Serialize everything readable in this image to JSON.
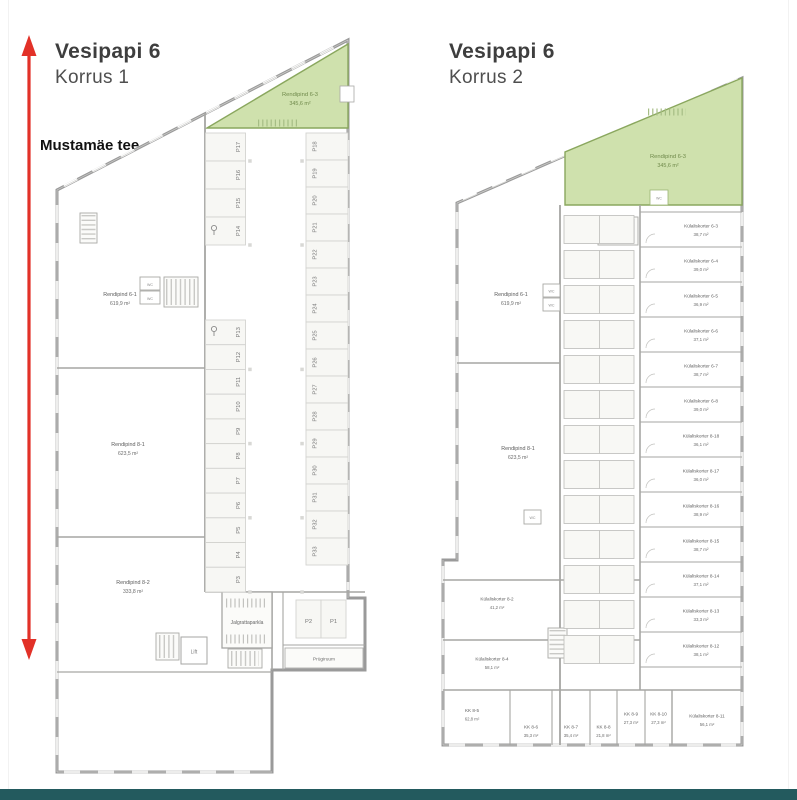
{
  "street_label": "Mustamäe tee",
  "labels": {
    "wc": "WC",
    "lift": "Lift",
    "bike_room": "Jalgrattaparkla",
    "waste_room": "Prügiruum"
  },
  "colors": {
    "highlight_fill": "#cfe1ad",
    "highlight_border": "#8aa75e",
    "arrow": "#e23128",
    "wall": "#9a9a9a",
    "footer": "#235a5e"
  },
  "left_plan": {
    "title": "Vesipapi 6",
    "subtitle": "Korrus 1",
    "highlight": {
      "name": "Rendipind 6-3",
      "size": "345,6 m²"
    },
    "areas": [
      {
        "name": "Rendipind 6-1",
        "size": "619,9 m²"
      },
      {
        "name": "Rendipind 8-1",
        "size": "623,5 m²"
      },
      {
        "name": "Rendipind 8-2",
        "size": "333,8 m²"
      }
    ],
    "parking_left": [
      "P17",
      "P16",
      "P15",
      "P14",
      "P13",
      "P12",
      "P11",
      "P10",
      "P9",
      "P8",
      "P7",
      "P6",
      "P5",
      "P4",
      "P3"
    ],
    "parking_right": [
      "P18",
      "P19",
      "P20",
      "P21",
      "P22",
      "P23",
      "P24",
      "P25",
      "P26",
      "P27",
      "P28",
      "P29",
      "P30",
      "P31",
      "P32",
      "P33"
    ],
    "parking_entry": [
      "P2",
      "P1"
    ]
  },
  "right_plan": {
    "title": "Vesipapi 6",
    "subtitle": "Korrus 2",
    "highlight": {
      "name": "Rendipind 6-3",
      "size": "345,6 m²"
    },
    "areas": [
      {
        "name": "Rendipind 6-1",
        "size": "619,9 m²"
      },
      {
        "name": "Rendipind 8-1",
        "size": "623,5 m²"
      }
    ],
    "units_right": [
      {
        "name": "Külaliskorter 6-3",
        "size": "38,7 m²"
      },
      {
        "name": "Külaliskorter 6-4",
        "size": "39,0 m²"
      },
      {
        "name": "Külaliskorter 6-5",
        "size": "36,9 m²"
      },
      {
        "name": "Külaliskorter 6-6",
        "size": "37,1 m²"
      },
      {
        "name": "Külaliskorter 6-7",
        "size": "38,7 m²"
      },
      {
        "name": "Külaliskorter 6-8",
        "size": "39,0 m²"
      },
      {
        "name": "Külaliskorter 8-18",
        "size": "36,1 m²"
      },
      {
        "name": "Külaliskorter 8-17",
        "size": "36,0 m²"
      },
      {
        "name": "Külaliskorter 8-16",
        "size": "38,9 m²"
      },
      {
        "name": "Külaliskorter 8-15",
        "size": "38,7 m²"
      },
      {
        "name": "Külaliskorter 8-14",
        "size": "37,1 m²"
      },
      {
        "name": "Külaliskorter 8-13",
        "size": "33,3 m²"
      },
      {
        "name": "Külaliskorter 8-12",
        "size": "38,1 m²"
      }
    ],
    "unit_corner": {
      "name": "Külaliskorter 8-11",
      "size": "56,1 m²"
    },
    "units_left": [
      {
        "name": "Külaliskorter 8-2",
        "size": "41,2 m²"
      },
      {
        "name": "Külaliskorter 8-4",
        "size": "58,1 m²"
      }
    ],
    "units_bottom": [
      {
        "name": "KK 8-5",
        "size": "62,8 m²"
      },
      {
        "name": "KK 8-6",
        "size": "35,3 m²"
      },
      {
        "name": "KK 8-7",
        "size": "35,4 m²"
      },
      {
        "name": "KK 8-8",
        "size": "21,8 m²"
      },
      {
        "name": "KK 8-9",
        "size": "27,3 m²"
      },
      {
        "name": "KK 8-10",
        "size": "27,3 m²"
      }
    ]
  }
}
